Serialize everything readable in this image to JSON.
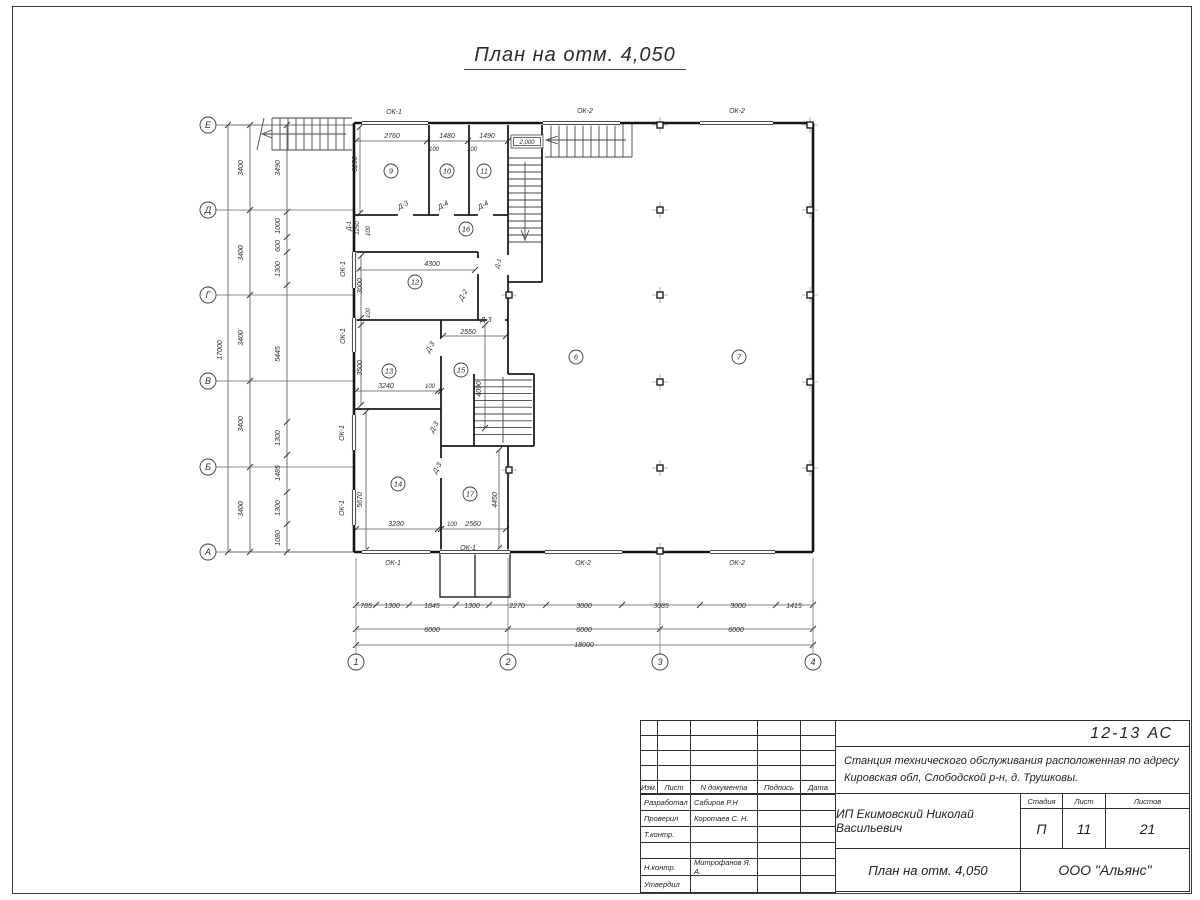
{
  "sheet": {
    "title": "План на отм. 4,050"
  },
  "plan": {
    "elevation_mark": "2,000",
    "axes_rows": [
      {
        "label": "Е",
        "y": 125
      },
      {
        "label": "Д",
        "y": 210
      },
      {
        "label": "Г",
        "y": 295
      },
      {
        "label": "В",
        "y": 381
      },
      {
        "label": "Б",
        "y": 467
      },
      {
        "label": "А",
        "y": 552
      }
    ],
    "axes_cols": [
      {
        "label": "1",
        "x": 356
      },
      {
        "label": "2",
        "x": 508
      },
      {
        "label": "3",
        "x": 660
      },
      {
        "label": "4",
        "x": 813
      }
    ],
    "rooms": [
      {
        "n": "9",
        "x": 391,
        "y": 171
      },
      {
        "n": "10",
        "x": 447,
        "y": 171
      },
      {
        "n": "11",
        "x": 484,
        "y": 171
      },
      {
        "n": "16",
        "x": 466,
        "y": 229
      },
      {
        "n": "12",
        "x": 415,
        "y": 282
      },
      {
        "n": "13",
        "x": 389,
        "y": 371
      },
      {
        "n": "15",
        "x": 461,
        "y": 370
      },
      {
        "n": "14",
        "x": 398,
        "y": 484
      },
      {
        "n": "17",
        "x": 470,
        "y": 494
      },
      {
        "n": "6",
        "x": 576,
        "y": 357
      },
      {
        "n": "7",
        "x": 739,
        "y": 357
      }
    ],
    "labels": [
      {
        "t": "17000",
        "x": 222,
        "y": 350,
        "r": -90
      },
      {
        "t": "3400",
        "x": 243,
        "y": 168,
        "r": -90
      },
      {
        "t": "3400",
        "x": 243,
        "y": 253,
        "r": -90
      },
      {
        "t": "3400",
        "x": 243,
        "y": 338,
        "r": -90
      },
      {
        "t": "3400",
        "x": 243,
        "y": 424,
        "r": -90
      },
      {
        "t": "3400",
        "x": 243,
        "y": 509,
        "r": -90
      },
      {
        "t": "3490",
        "x": 280,
        "y": 168,
        "r": -90
      },
      {
        "t": "1000",
        "x": 280,
        "y": 226,
        "r": -90
      },
      {
        "t": "600",
        "x": 280,
        "y": 246,
        "r": -90
      },
      {
        "t": "1300",
        "x": 280,
        "y": 269,
        "r": -90
      },
      {
        "t": "5445",
        "x": 280,
        "y": 354,
        "r": -90
      },
      {
        "t": "1300",
        "x": 280,
        "y": 438,
        "r": -90
      },
      {
        "t": "1485",
        "x": 280,
        "y": 473,
        "r": -90
      },
      {
        "t": "1300",
        "x": 280,
        "y": 508,
        "r": -90
      },
      {
        "t": "1080",
        "x": 280,
        "y": 538,
        "r": -90
      },
      {
        "t": "2760",
        "x": 392,
        "y": 138
      },
      {
        "t": "1480",
        "x": 447,
        "y": 138
      },
      {
        "t": "1490",
        "x": 487,
        "y": 138
      },
      {
        "t": "100",
        "x": 434,
        "y": 151,
        "s": 6
      },
      {
        "t": "100",
        "x": 472,
        "y": 151,
        "s": 6
      },
      {
        "t": "3250",
        "x": 357,
        "y": 164,
        "r": -90
      },
      {
        "t": "ОК-1",
        "x": 394,
        "y": 114
      },
      {
        "t": "ОК-2",
        "x": 585,
        "y": 113
      },
      {
        "t": "ОК-2",
        "x": 737,
        "y": 113
      },
      {
        "t": "Д-3",
        "x": 404,
        "y": 207,
        "r": -28
      },
      {
        "t": "Д-4",
        "x": 444,
        "y": 207,
        "r": -28
      },
      {
        "t": "Д-4",
        "x": 484,
        "y": 207,
        "r": -28
      },
      {
        "t": "Д-1",
        "x": 351,
        "y": 226,
        "r": -90,
        "s": 6
      },
      {
        "t": "1250",
        "x": 359,
        "y": 228,
        "r": -90,
        "s": 6
      },
      {
        "t": "100",
        "x": 370,
        "y": 231,
        "r": -90,
        "s": 6
      },
      {
        "t": "3000",
        "x": 362,
        "y": 286,
        "r": -90
      },
      {
        "t": "100",
        "x": 370,
        "y": 313,
        "r": -90,
        "s": 6
      },
      {
        "t": "3500",
        "x": 362,
        "y": 368,
        "r": -90
      },
      {
        "t": "5670",
        "x": 362,
        "y": 500,
        "r": -90
      },
      {
        "t": "4300",
        "x": 432,
        "y": 266
      },
      {
        "t": "Д-1",
        "x": 500,
        "y": 264,
        "r": -75,
        "s": 6
      },
      {
        "t": "Д-2",
        "x": 465,
        "y": 296,
        "r": -60
      },
      {
        "t": "Д-3",
        "x": 486,
        "y": 322
      },
      {
        "t": "2550",
        "x": 468,
        "y": 334
      },
      {
        "t": "Д-3",
        "x": 432,
        "y": 348,
        "r": -60
      },
      {
        "t": "3240",
        "x": 386,
        "y": 388
      },
      {
        "t": "100",
        "x": 430,
        "y": 388,
        "s": 6
      },
      {
        "t": "4090",
        "x": 481,
        "y": 389,
        "r": -90
      },
      {
        "t": "Д-3",
        "x": 436,
        "y": 428,
        "r": -60
      },
      {
        "t": "Д-3",
        "x": 439,
        "y": 469,
        "r": -60
      },
      {
        "t": "4450",
        "x": 497,
        "y": 500,
        "r": -90
      },
      {
        "t": "3230",
        "x": 396,
        "y": 526
      },
      {
        "t": "100",
        "x": 452,
        "y": 526,
        "s": 6
      },
      {
        "t": "2560",
        "x": 473,
        "y": 526
      },
      {
        "t": "ОК-1",
        "x": 345,
        "y": 269,
        "r": -90
      },
      {
        "t": "ОК-1",
        "x": 345,
        "y": 336,
        "r": -90
      },
      {
        "t": "ОК-1",
        "x": 344,
        "y": 433,
        "r": -90
      },
      {
        "t": "ОК-1",
        "x": 344,
        "y": 508,
        "r": -90
      },
      {
        "t": "ОК-1",
        "x": 393,
        "y": 565
      },
      {
        "t": "ОК-1",
        "x": 468,
        "y": 550
      },
      {
        "t": "ОК-2",
        "x": 583,
        "y": 565
      },
      {
        "t": "ОК-2",
        "x": 737,
        "y": 565
      },
      {
        "t": "785",
        "x": 366,
        "y": 608
      },
      {
        "t": "1300",
        "x": 392,
        "y": 608
      },
      {
        "t": "1845",
        "x": 432,
        "y": 608
      },
      {
        "t": "1300",
        "x": 472,
        "y": 608
      },
      {
        "t": "2270",
        "x": 517,
        "y": 608
      },
      {
        "t": "3000",
        "x": 584,
        "y": 608
      },
      {
        "t": "3085",
        "x": 661,
        "y": 608
      },
      {
        "t": "3000",
        "x": 738,
        "y": 608
      },
      {
        "t": "1415",
        "x": 794,
        "y": 608
      },
      {
        "t": "6000",
        "x": 432,
        "y": 632
      },
      {
        "t": "6000",
        "x": 584,
        "y": 632
      },
      {
        "t": "6000",
        "x": 736,
        "y": 632
      },
      {
        "t": "18000",
        "x": 584,
        "y": 647
      },
      {
        "t": "2,000",
        "x": 527,
        "y": 144,
        "s": 6
      }
    ]
  },
  "titleblock": {
    "doc_number": "12-13 АС",
    "project_line1": "Станция технического обслуживания расположенная по адресу",
    "project_line2": "Кировская обл, Слободской р-н, д. Трушковы.",
    "client": "ИП Екимовский Николай Васильевич",
    "drawing_title": "План на отм. 4,050",
    "company": "ООО \"Альянс\"",
    "cols": {
      "izm": "Изм.",
      "list": "Лист",
      "doc": "N документа",
      "sign": "Подпись",
      "date": "Дата"
    },
    "roles": [
      {
        "role": "Разработал",
        "name": "Сабиров Р.Н"
      },
      {
        "role": "Проверил",
        "name": "Коротаев С. Н."
      },
      {
        "role": "Т.контр.",
        "name": ""
      },
      {
        "role": "",
        "name": ""
      },
      {
        "role": "Н.контр.",
        "name": "Митрофанов Я. А."
      },
      {
        "role": "Утвердил",
        "name": ""
      }
    ],
    "stage": {
      "label": "Стадия",
      "value": "П"
    },
    "sheet_no": {
      "label": "Лист",
      "value": "11"
    },
    "sheets_total": {
      "label": "Листов",
      "value": "21"
    }
  }
}
